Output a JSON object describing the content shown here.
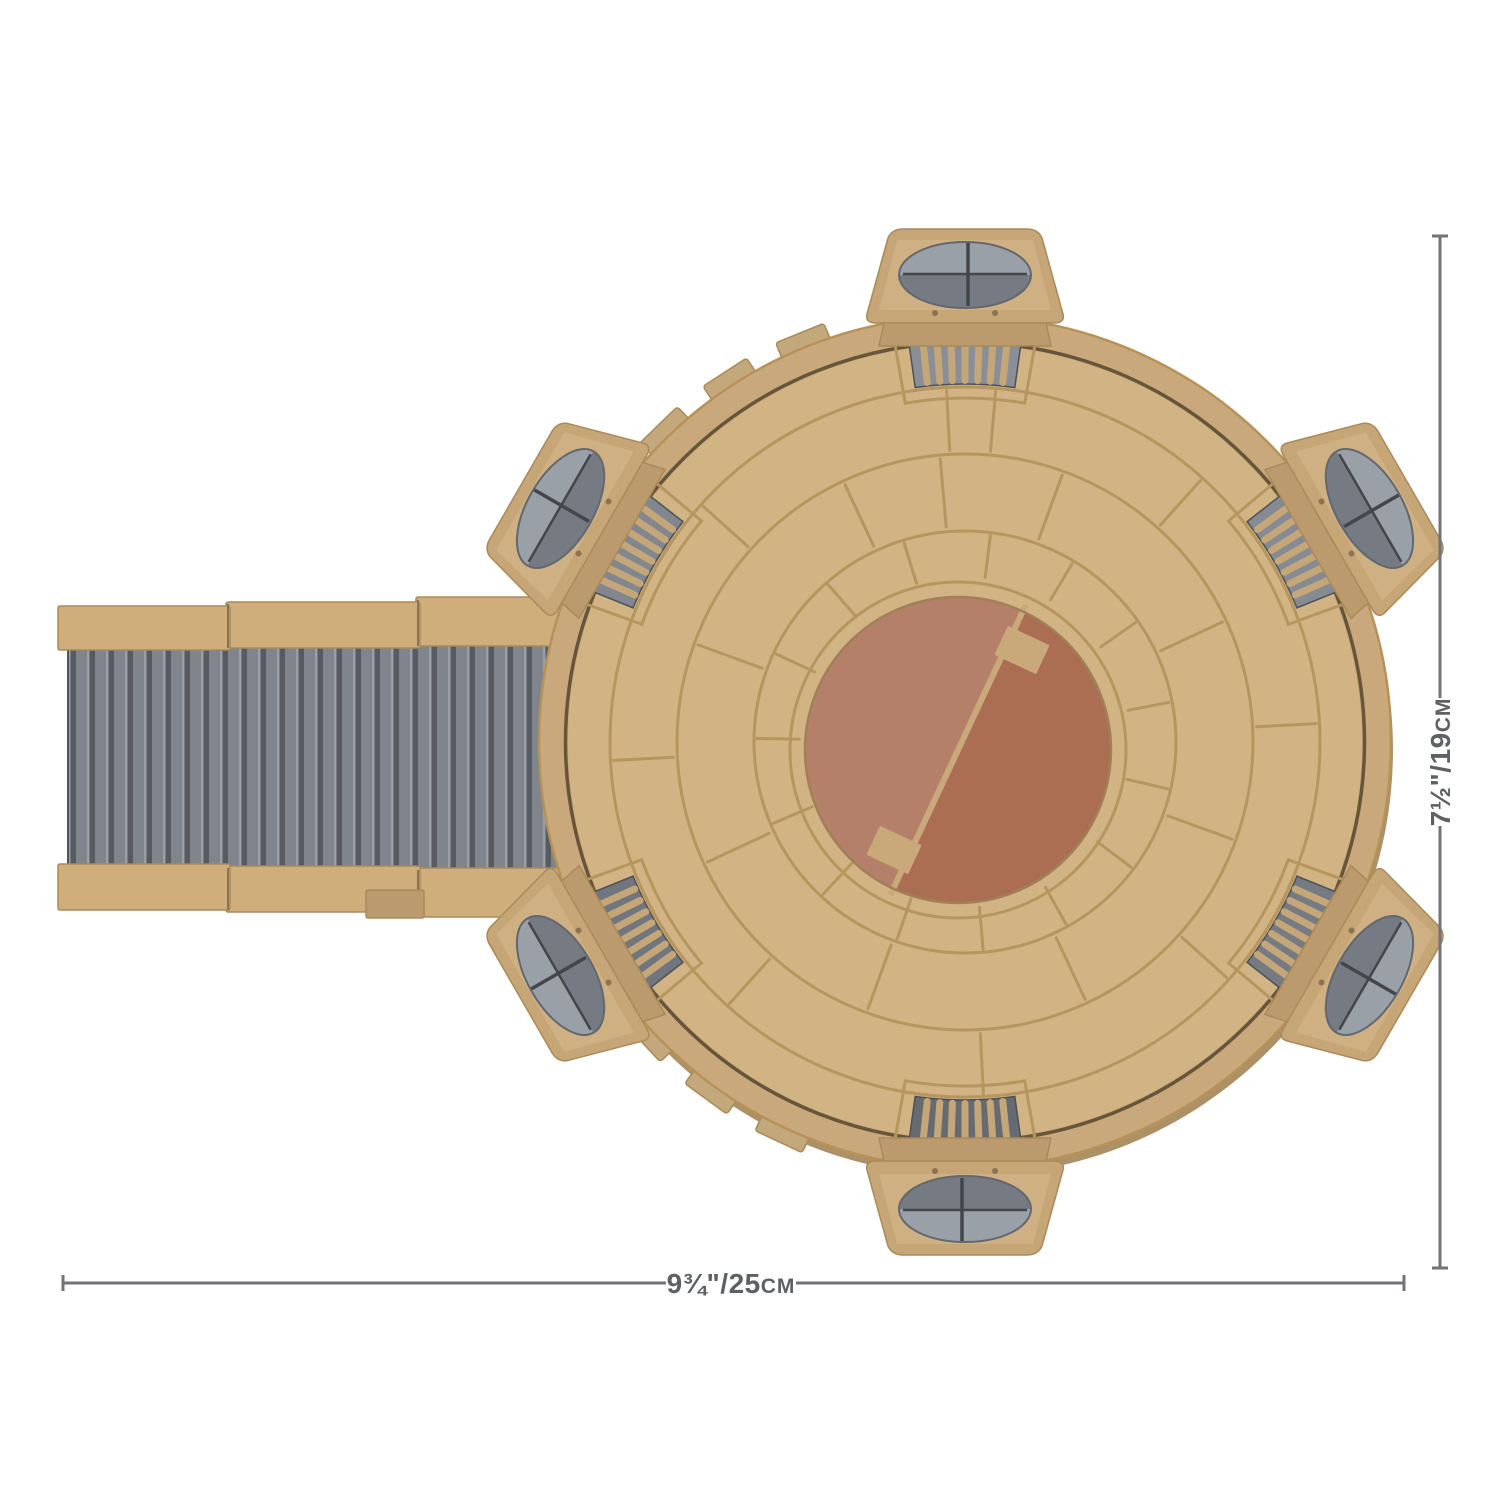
{
  "scene": {
    "subject": "tan circular landing platform playset with boarding ramp, top view",
    "view": "top-down product photo"
  },
  "dimensions": {
    "width": {
      "imperial": "9¾\"",
      "separator": "/",
      "metric_value": "25",
      "metric_unit": "cm",
      "full": "9¾\"/25cm"
    },
    "height": {
      "imperial": "7½\"",
      "separator": "/",
      "metric_value": "19",
      "metric_unit": "cm",
      "full": "7½\"/19cm"
    }
  },
  "colors": {
    "background": "#ffffff",
    "dimension_line": "#707478",
    "dimension_text": "#5d6165",
    "platform_rim": "#c9a97b",
    "platform_rim_edge": "#b69259",
    "platform_disc": "#d2b383",
    "panel_line": "#b6965f",
    "groove_dark": "#55472f",
    "under_shadow": "#ad9166",
    "pad_left": "#b5806a",
    "pad_right": "#ab6e52",
    "pad_divider": "#c9a87a",
    "pad_edge": "#a08058",
    "grille_slot": "#c4a678",
    "pod_body": "#c6a577",
    "pod_face": "#cfb083",
    "pod_base": "#bb9b6d",
    "pod_oval": "#9aa0a8",
    "pod_oval_shadow": "#757a83",
    "pod_oval_line": "#43464b",
    "pod_edge": "#a98a58",
    "ramp_rail": "#cfae7c",
    "ramp_deck": "#80858d",
    "ramp_rib_dark": "#575b61",
    "ramp_rib_light": "#999fa7",
    "tab_fill": "#c3a87c",
    "dot_fill": "#8a7350"
  },
  "grille_shades": [
    "#8a8f97",
    "#868b93",
    "#767b83",
    "#666a71",
    "#71767e",
    "#82878f"
  ]
}
